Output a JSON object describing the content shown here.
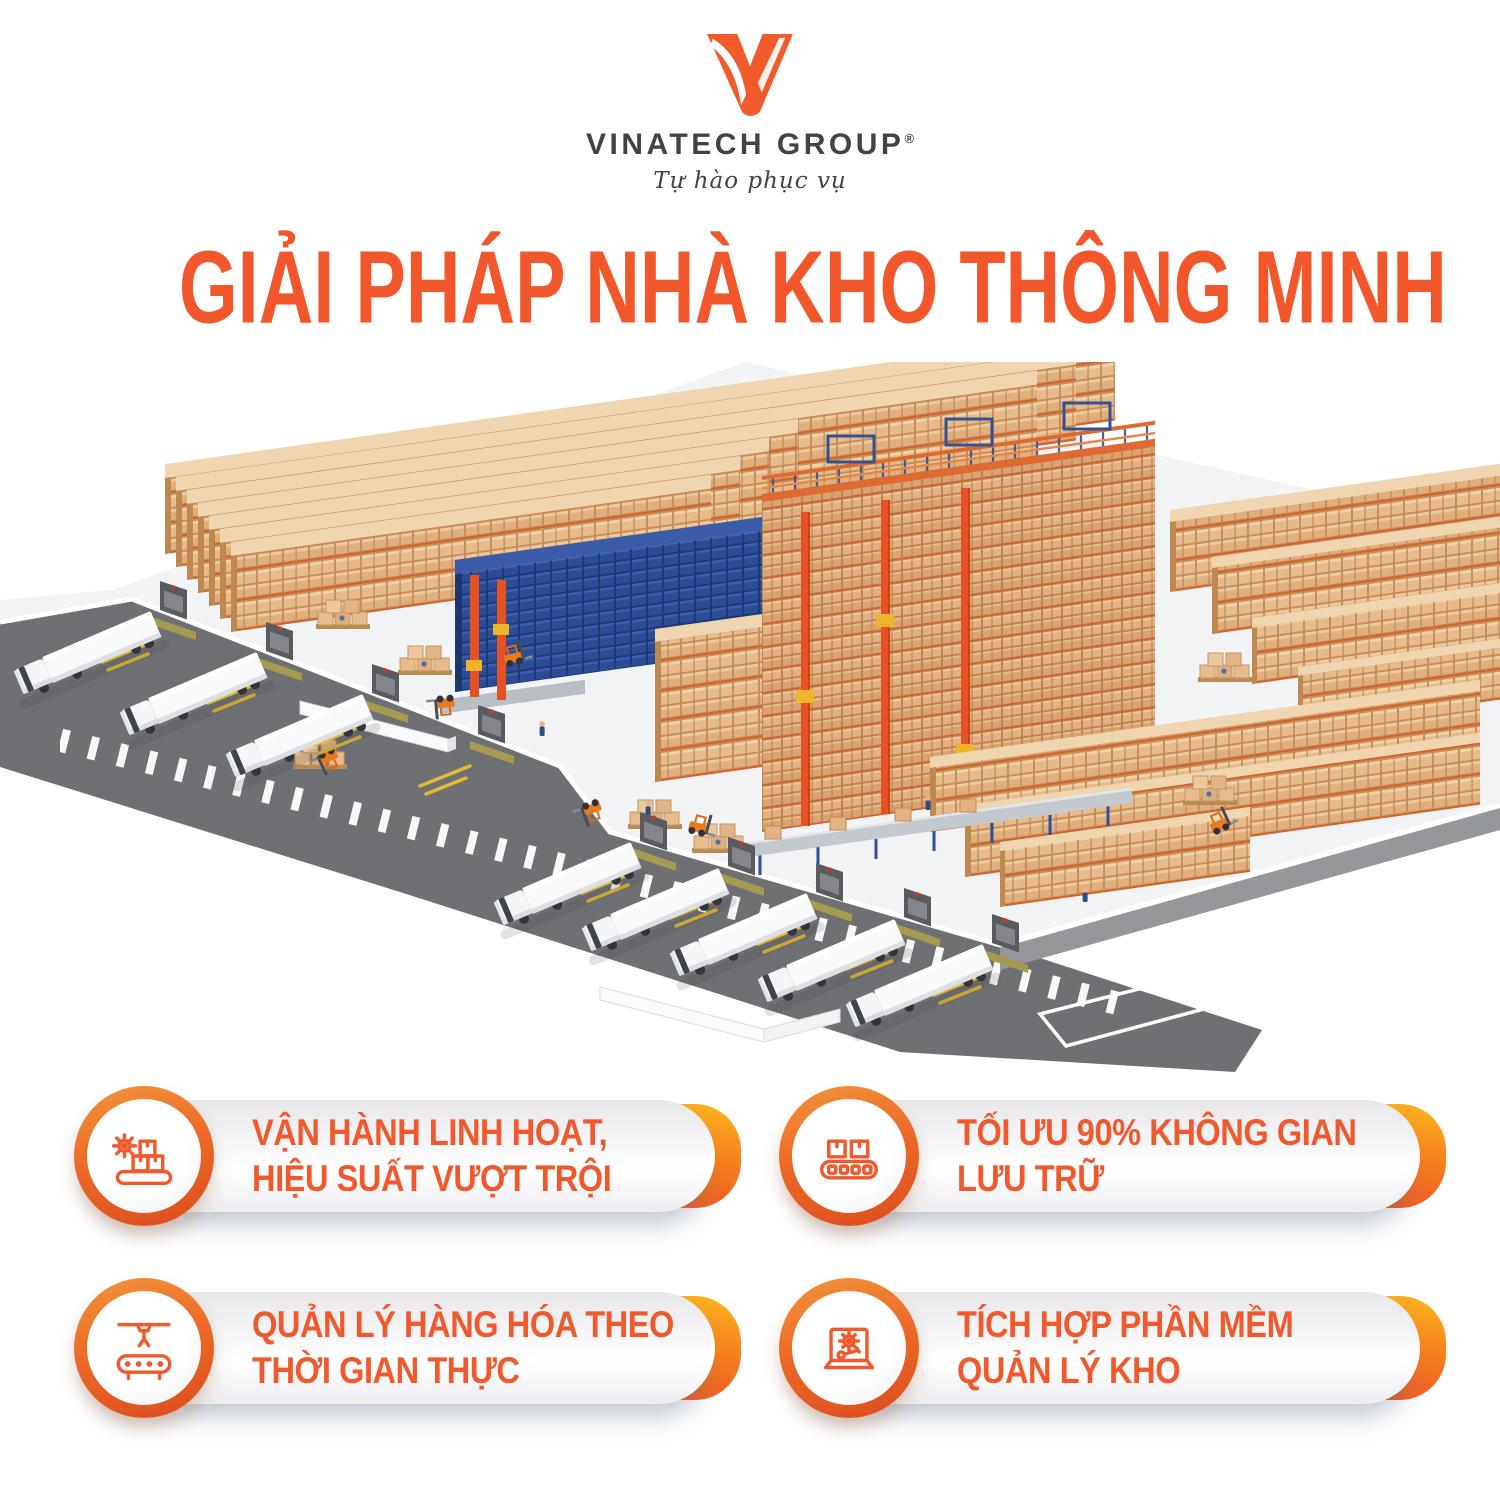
{
  "brand": {
    "name": "VINATECH GROUP",
    "registered_mark": "®",
    "tagline": "Tự hào phục vụ"
  },
  "title": "GIẢI PHÁP NHÀ KHO THÔNG MINH",
  "illustration": {
    "subject": "isometric-smart-warehouse",
    "elements": [
      "pallet-racking-rows",
      "drive-in-blue-racking",
      "asrs-stacker-cranes",
      "mezzanine-conveyor",
      "loading-docks",
      "semi-trailer-trucks",
      "forklifts",
      "pallet-box-stacks",
      "access-road"
    ]
  },
  "features": [
    {
      "icon": "gear-boxes-conveyor-icon",
      "lines": [
        "VẬN HÀNH LINH HOẠT,",
        "HIỆU SUẤT VƯỢT TRỘI"
      ]
    },
    {
      "icon": "boxes-roller-conveyor-icon",
      "lines": [
        "TỐI ƯU 90% KHÔNG GIAN",
        "LƯU TRỮ"
      ]
    },
    {
      "icon": "robotic-arm-conveyor-icon",
      "lines": [
        "QUẢN LÝ HÀNG HÓA THEO",
        "THỜI GIAN THỰC"
      ]
    },
    {
      "icon": "laptop-gear-wrench-icon",
      "lines": [
        "TÍCH HỢP PHẦN MỀM",
        "QUẢN LÝ KHO"
      ]
    }
  ],
  "colors": {
    "accent_orange": "#F1582B",
    "title_orange": "#F2572B",
    "logo_orange": "#F15A29",
    "bracket_gradient_top": "#FBAC1D",
    "bracket_gradient_bottom": "#EF5A22",
    "dark_text": "#3F434A",
    "road_gray": "#6F7073",
    "rack_tan": "#E6BB8C",
    "rack_blue": "#2C4C97",
    "crane_orange": "#E55224",
    "floor_light": "#F2F3F5"
  }
}
